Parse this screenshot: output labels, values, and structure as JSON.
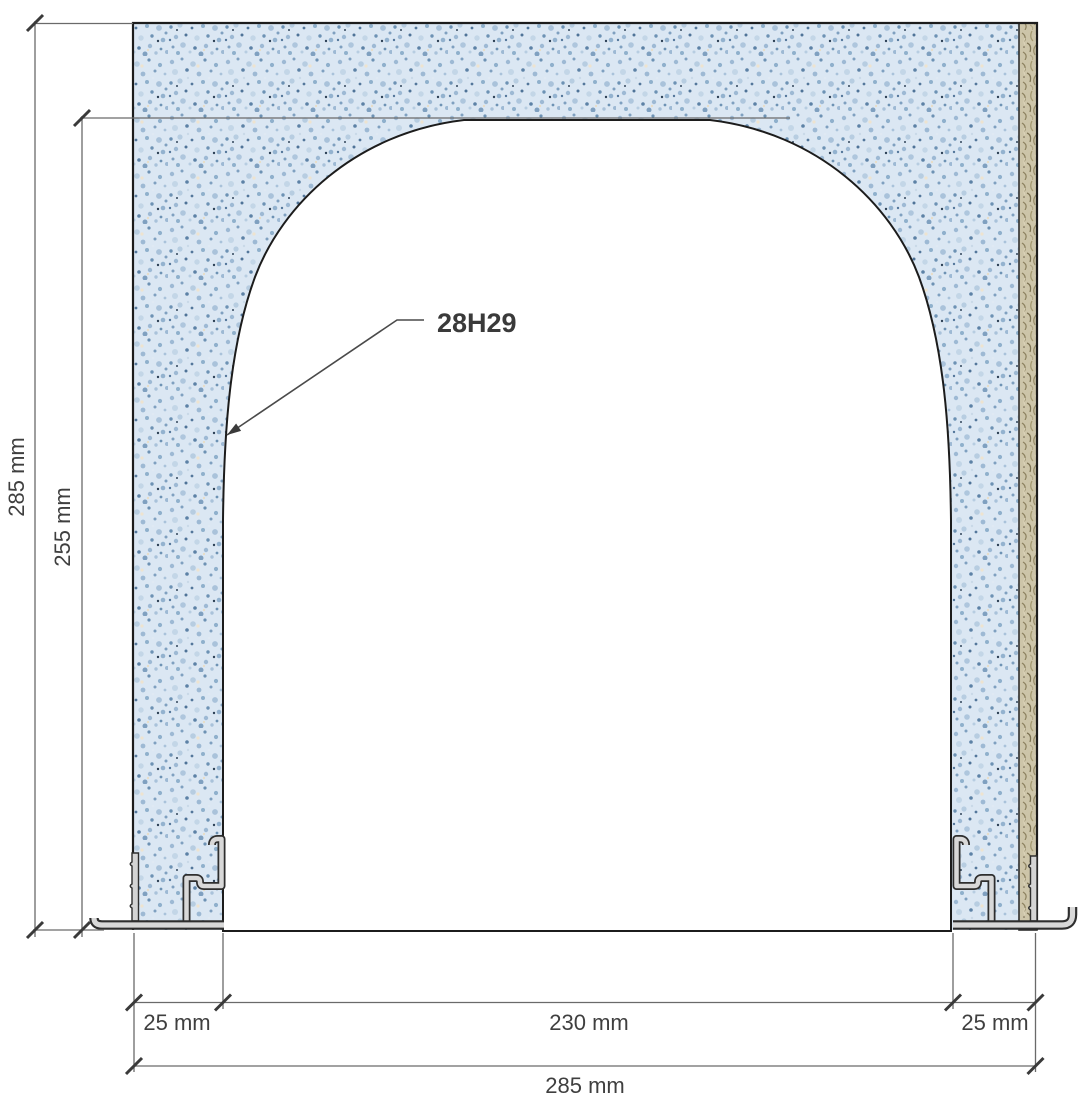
{
  "drawing": {
    "title": "wall-section-with-arched-opening",
    "part_label": "28H29",
    "dimensions": {
      "left_outer_height": "285 mm",
      "left_inner_height": "255 mm",
      "bottom_left_jamb": "25 mm",
      "bottom_opening_width": "230 mm",
      "bottom_right_jamb": "25 mm",
      "bottom_total_width": "285 mm"
    },
    "colors": {
      "board_blue_base": "#dbe7f3",
      "board_blue_speckle": "#7fa0c0",
      "wood_strip_base": "#cdc5a9",
      "wood_strip_fiber": "#8d8260",
      "metal_fill": "#d4d4d4",
      "metal_outline": "#2e2e2e",
      "outline_black": "#1c1c1c",
      "dimension_line_gray": "#6a6a6a",
      "tick_dark": "#3a3a3a",
      "text_gray": "#3f3f3f",
      "background": "#ffffff"
    }
  }
}
